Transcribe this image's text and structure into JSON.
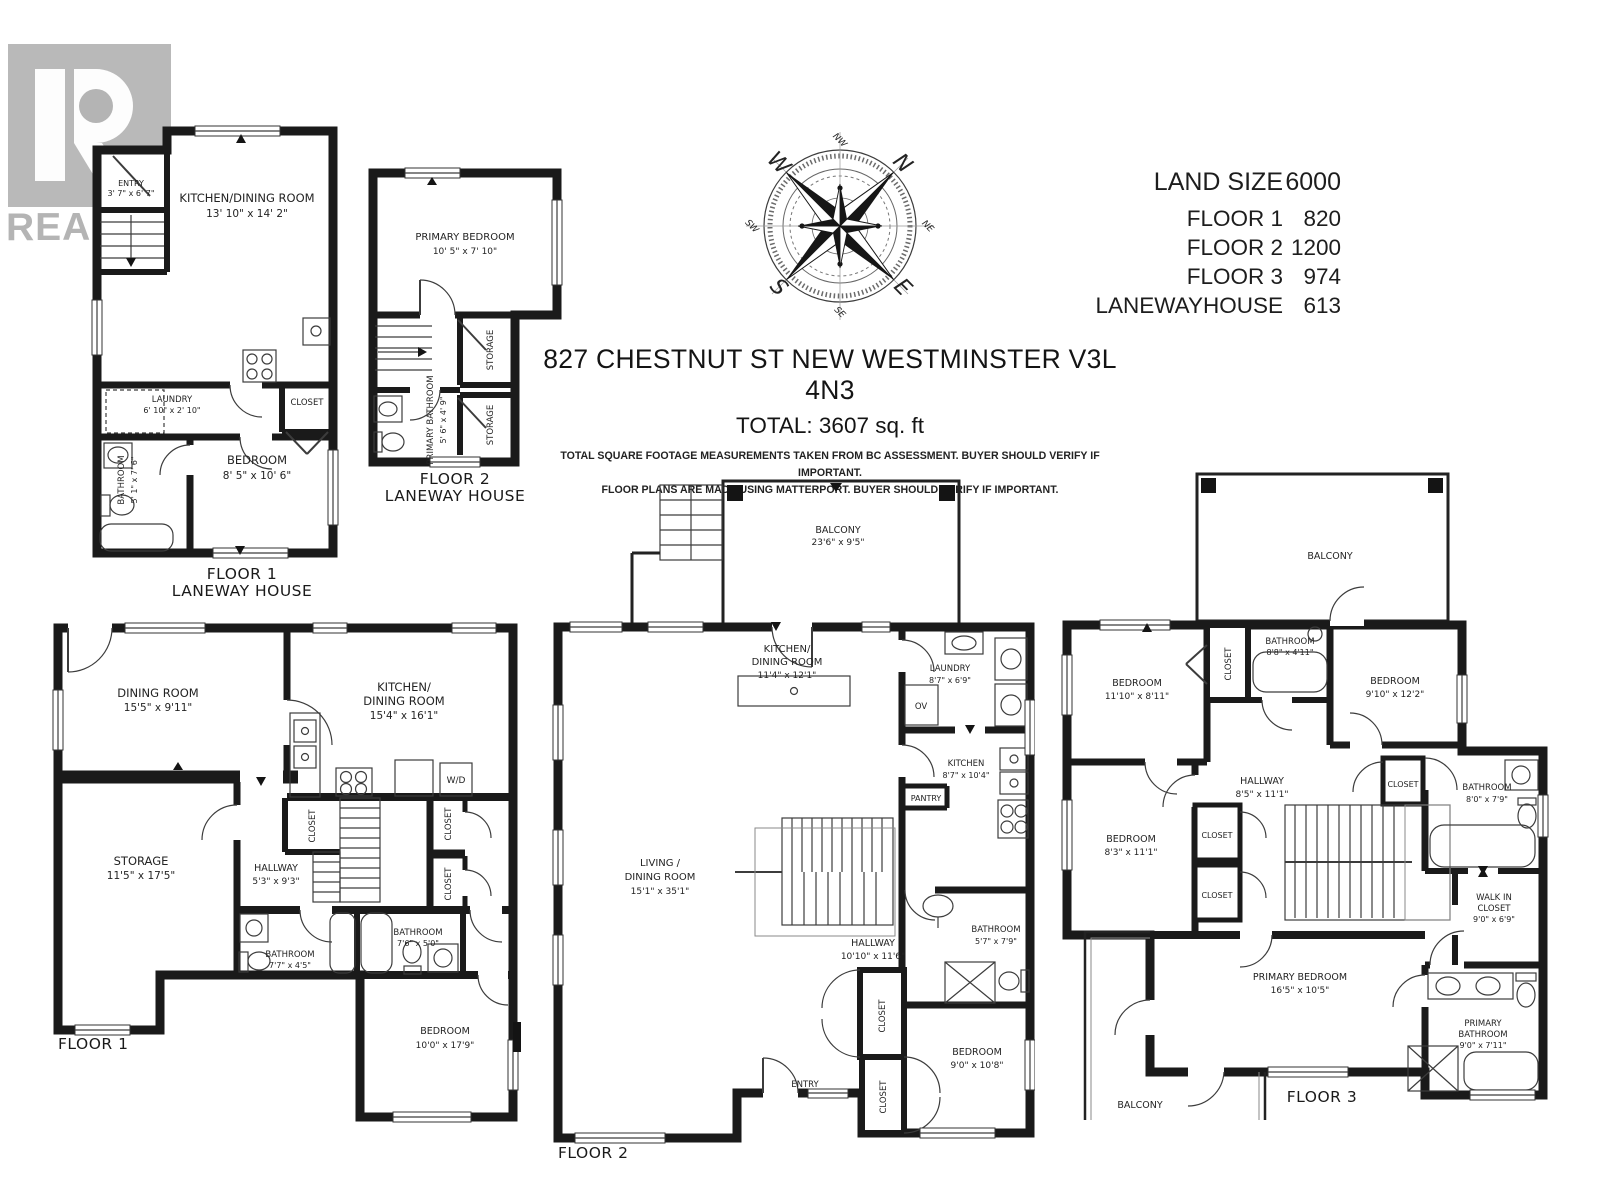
{
  "watermark": {
    "logo_letter": "R",
    "brand": "REALTOR",
    "reg": "®"
  },
  "compass": {
    "n": "N",
    "e": "E",
    "s": "S",
    "w": "W",
    "nw": "NW",
    "ne": "NE",
    "se": "SE",
    "sw": "SW"
  },
  "summary": {
    "rows": [
      {
        "label": "LAND SIZE",
        "value": "6000"
      },
      {
        "label": "FLOOR 1",
        "value": "820"
      },
      {
        "label": "FLOOR 2",
        "value": "1200"
      },
      {
        "label": "FLOOR 3",
        "value": "974"
      },
      {
        "label": "LANEWAYHOUSE",
        "value": "613"
      }
    ]
  },
  "header": {
    "address": "827 CHESTNUT ST NEW WESTMINSTER V3L 4N3",
    "total": "TOTAL: 3607 sq. ft",
    "disclaimer_line1": "TOTAL SQUARE FOOTAGE MEASUREMENTS TAKEN FROM BC ASSESSMENT. BUYER SHOULD VERIFY IF IMPORTANT.",
    "disclaimer_line2": "FLOOR PLANS ARE MADE USING MATTERPORT. BUYER SHOULD VERIFY IF IMPORTANT."
  },
  "plans": {
    "l1": {
      "cap1": "FLOOR 1",
      "cap2": "LANEWAY HOUSE",
      "entry_n": "ENTRY",
      "entry_d": "3' 7\" x 6' 7\"",
      "kit_n": "KITCHEN/DINING ROOM",
      "kit_d": "13' 10\" x 14' 2\"",
      "lau_n": "LAUNDRY",
      "lau_d": "6' 10\" x 2' 10\"",
      "clo": "CLOSET",
      "bath_n": "BATHROOM",
      "bath_d": "5' 1\" x 7' 6\"",
      "bed_n": "BEDROOM",
      "bed_d": "8' 5\" x 10' 6\""
    },
    "l2": {
      "cap1": "FLOOR 2",
      "cap2": "LANEWAY HOUSE",
      "pbed_n": "PRIMARY BEDROOM",
      "pbed_d": "10' 5\" x 7' 10\"",
      "sto1": "STORAGE",
      "sto2": "STORAGE",
      "pbath_n": "PRIMARY BATHROOM",
      "pbath_d": "5' 6\" x 4' 9\""
    },
    "f1": {
      "cap": "FLOOR 1",
      "din_n": "DINING ROOM",
      "din_d": "15'5\" x 9'11\"",
      "kit1": "KITCHEN/",
      "kit2": "DINING ROOM",
      "kit_d": "15'4\" x 16'1\"",
      "wd": "W/D",
      "sto_n": "STORAGE",
      "sto_d": "11'5\" x 17'5\"",
      "hal_n": "HALLWAY",
      "hal_d": "5'3\" x 9'3\"",
      "clo1": "CLOSET",
      "clo2": "CLOSET",
      "clo3": "CLOSET",
      "ba1_n": "BATHROOM",
      "ba1_d": "7'7\" x 4'5\"",
      "ba2_n": "BATHROOM",
      "ba2_d": "7'6\" x 5'0\"",
      "bed_n": "BEDROOM",
      "bed_d": "10'0\" x 17'9\""
    },
    "f2": {
      "cap": "FLOOR 2",
      "bal_n": "BALCONY",
      "bal_d": "23'6\" x 9'5\"",
      "kd1": "KITCHEN/",
      "kd2": "DINING ROOM",
      "kd_d": "11'4\" x 12'1\"",
      "lau_n": "LAUNDRY",
      "lau_d": "8'7\" x 6'9\"",
      "ov": "OV",
      "kit_n": "KITCHEN",
      "kit_d": "8'7\" x 10'4\"",
      "pan": "PANTRY",
      "liv1": "LIVING /",
      "liv2": "DINING ROOM",
      "liv_d": "15'1\" x 35'1\"",
      "hal_n": "HALLWAY",
      "hal_d": "10'10\" x 11'6\"",
      "ba_n": "BATHROOM",
      "ba_d": "5'7\" x 7'9\"",
      "clo1": "CLOSET",
      "clo2": "CLOSET",
      "ent": "ENTRY",
      "bed_n": "BEDROOM",
      "bed_d": "9'0\" x 10'8\""
    },
    "f3": {
      "cap": "FLOOR 3",
      "balt": "BALCONY",
      "balb": "BALCONY",
      "bed1_n": "BEDROOM",
      "bed1_d": "11'10\" x 8'11\"",
      "clo1": "CLOSET",
      "ba1_n": "BATHROOM",
      "ba1_d": "8'8\" x 4'11\"",
      "bed2_n": "BEDROOM",
      "bed2_d": "9'10\" x 12'2\"",
      "hal_n": "HALLWAY",
      "hal_d": "8'5\" x 11'1\"",
      "clo2": "CLOSET",
      "ba2_n": "BATHROOM",
      "ba2_d": "8'0\" x 7'9\"",
      "bed3_n": "BEDROOM",
      "bed3_d": "8'3\" x 11'1\"",
      "clo3": "CLOSET",
      "clo4": "CLOSET",
      "wi1": "WALK IN",
      "wi2": "CLOSET",
      "wi_d": "9'0\" x 6'9\"",
      "pbed_n": "PRIMARY BEDROOM",
      "pbed_d": "16'5\" x 10'5\"",
      "pba1": "PRIMARY",
      "pba2": "BATHROOM",
      "pba_d": "9'0\" x 7'11\""
    }
  }
}
